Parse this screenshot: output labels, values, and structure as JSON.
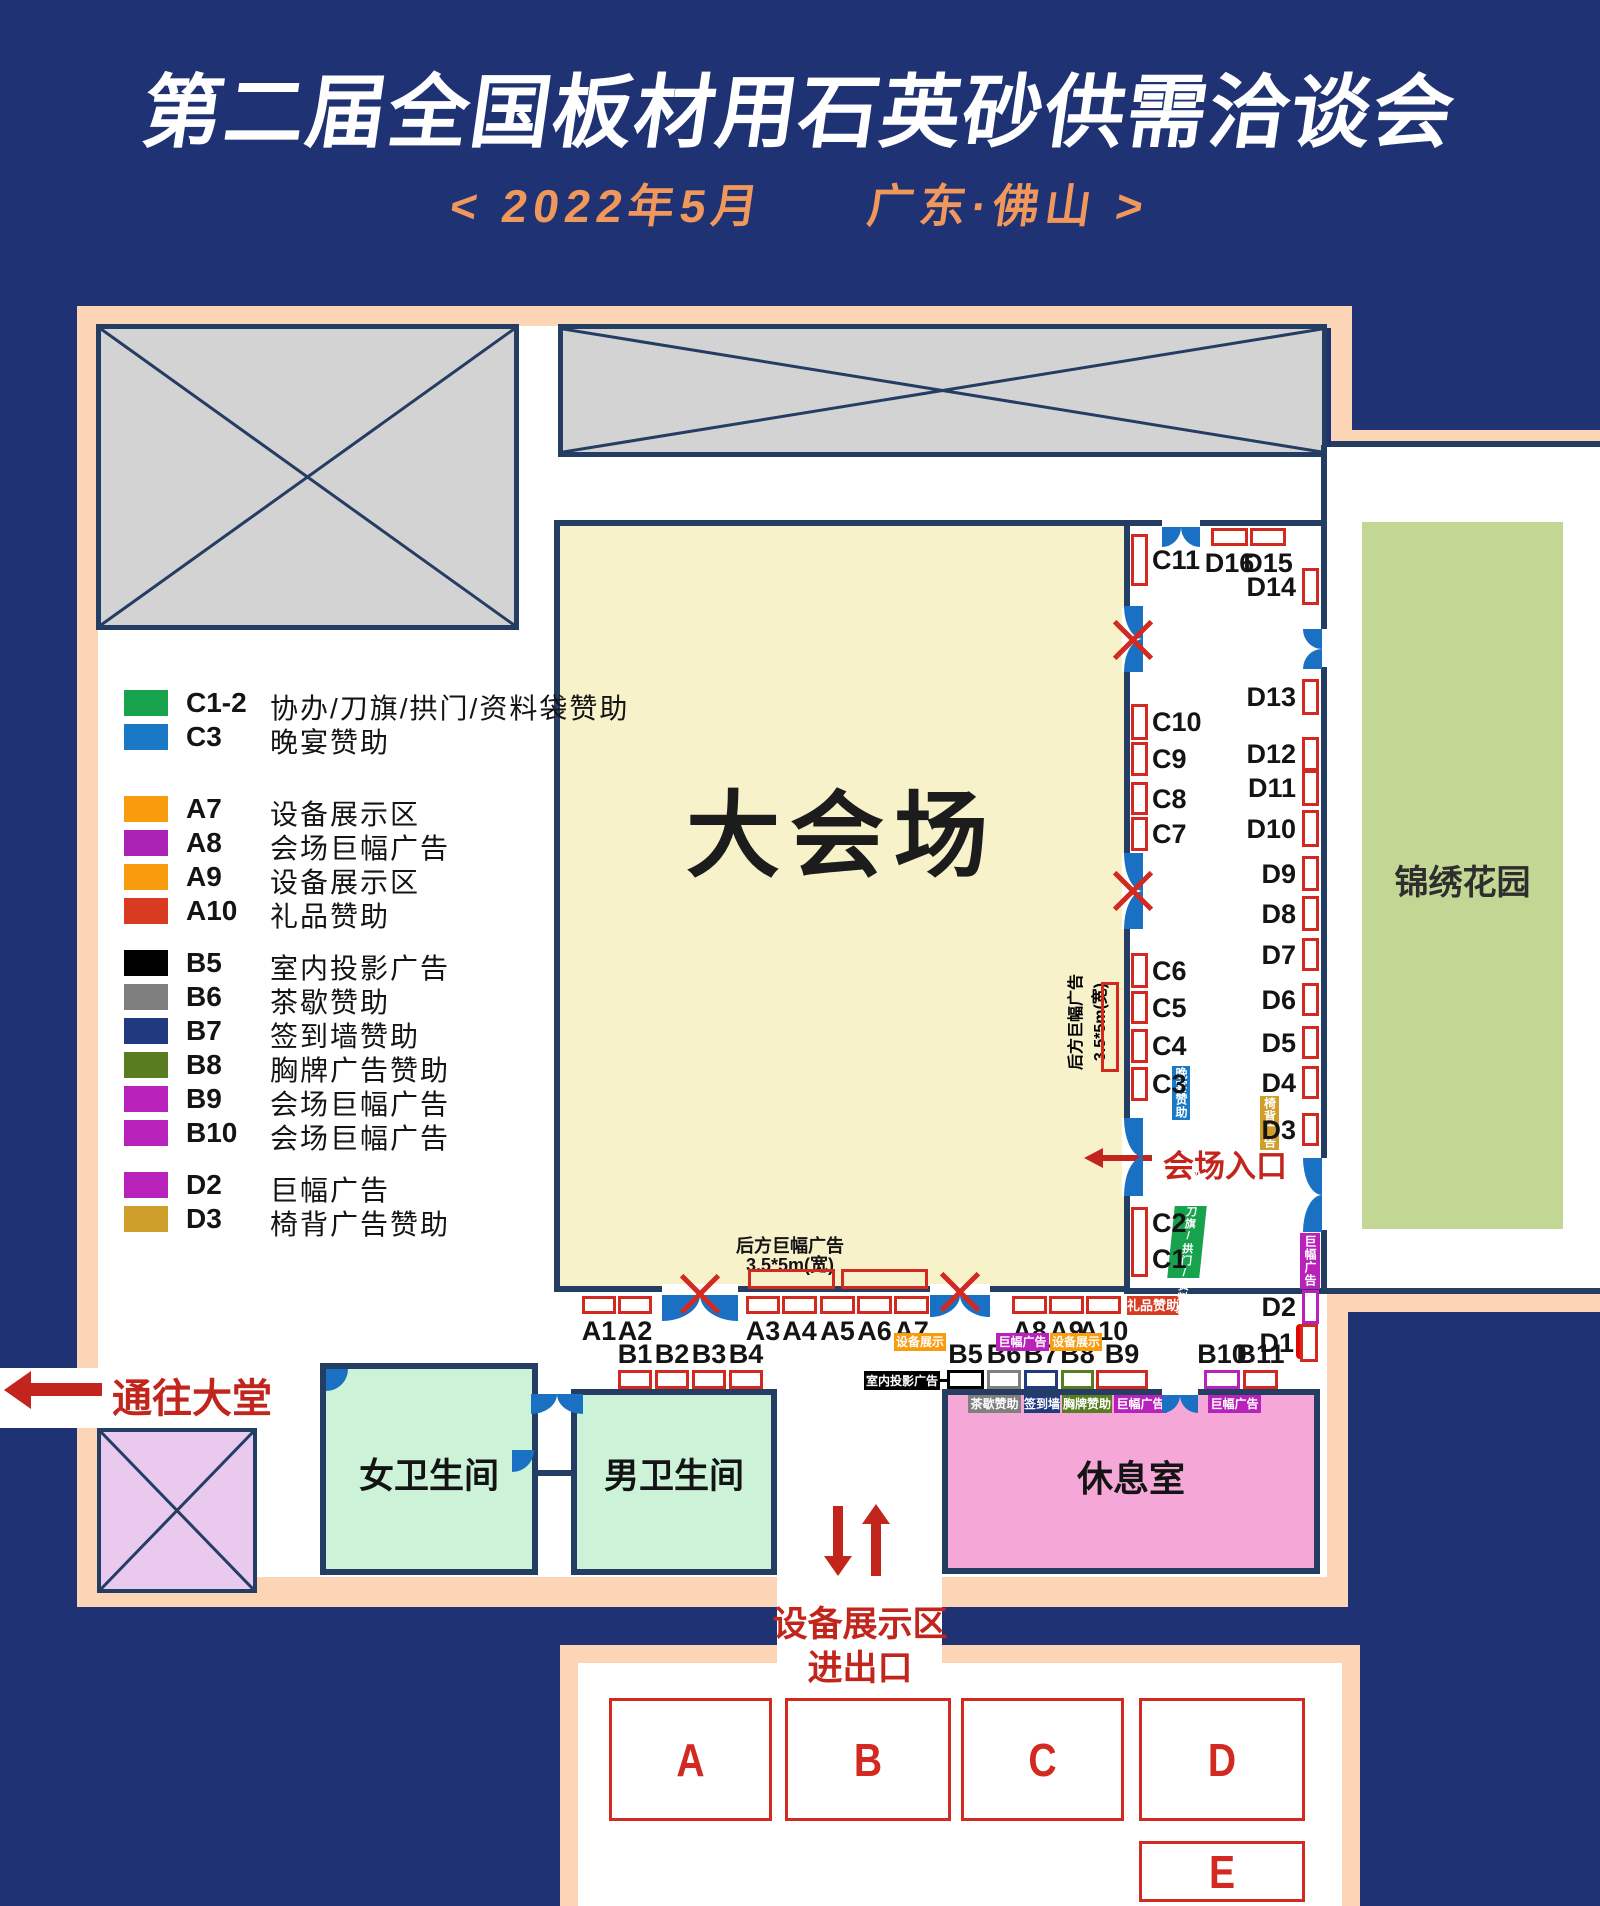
{
  "texts": {
    "title": "第二届全国板材用石英砂供需洽谈会",
    "subtitle": "<  2022年5月　　广东·佛山  >",
    "hall": "大会场",
    "garden": "锦绣花园",
    "lounge": "休息室",
    "women": "女卫生间",
    "men": "男卫生间",
    "lobby": "通往大堂",
    "hall_entrance": "会场入口",
    "equip_line1": "设备展示区",
    "equip_line2": "进出口",
    "rear_banner_line1": "后方巨幅广告",
    "rear_banner_line2": "3.5*5m(宽)"
  },
  "tags": {
    "gift": "礼品赞助",
    "equipment": "设备展示",
    "banner": "巨幅广告",
    "projection": "室内投影广告",
    "tea": "茶歇赞助",
    "signwall": "签到墙",
    "badge": "胸牌赞助",
    "dinner": "晚宴赞助",
    "chair": "椅背广告",
    "coorg": "协办/刀旗/拱门/资料袋"
  },
  "legend": {
    "items": [
      {
        "code": "C1-2",
        "label": "协办/刀旗/拱门/资料袋赞助",
        "color": "#17a24d",
        "group": 0
      },
      {
        "code": "C3",
        "label": "晚宴赞助",
        "color": "#1a79c6",
        "group": 0
      },
      {
        "code": "A7",
        "label": "设备展示区",
        "color": "#f89b0d",
        "group": 1
      },
      {
        "code": "A8",
        "label": "会场巨幅广告",
        "color": "#ab23b5",
        "group": 1
      },
      {
        "code": "A9",
        "label": "设备展示区",
        "color": "#f89b0d",
        "group": 1
      },
      {
        "code": "A10",
        "label": "礼品赞助",
        "color": "#d83b20",
        "group": 1
      },
      {
        "code": "B5",
        "label": "室内投影广告",
        "color": "#000000",
        "group": 2
      },
      {
        "code": "B6",
        "label": "茶歇赞助",
        "color": "#7f7f7f",
        "group": 2
      },
      {
        "code": "B7",
        "label": "签到墙赞助",
        "color": "#20397f",
        "group": 2
      },
      {
        "code": "B8",
        "label": "胸牌广告赞助",
        "color": "#5a7c20",
        "group": 2
      },
      {
        "code": "B9",
        "label": "会场巨幅广告",
        "color": "#b822bb",
        "group": 2
      },
      {
        "code": "B10",
        "label": "会场巨幅广告",
        "color": "#b822bb",
        "group": 2
      },
      {
        "code": "D2",
        "label": "巨幅广告",
        "color": "#b822bb",
        "group": 3
      },
      {
        "code": "D3",
        "label": "椅背广告赞助",
        "color": "#cf9f2b",
        "group": 3
      }
    ]
  },
  "booths": {
    "A1": "A1",
    "A2": "A2",
    "A3": "A3",
    "A4": "A4",
    "A5": "A5",
    "A6": "A6",
    "A7": "A7",
    "A8": "A8",
    "A9": "A9",
    "A10": "A10",
    "B1": "B1",
    "B2": "B2",
    "B3": "B3",
    "B4": "B4",
    "B5": "B5",
    "B6": "B6",
    "B7": "B7",
    "B8": "B8",
    "B9": "B9",
    "B10": "B10",
    "B11": "B11",
    "C1": "C1",
    "C2": "C2",
    "C3": "C3",
    "C4": "C4",
    "C5": "C5",
    "C6": "C6",
    "C7": "C7",
    "C8": "C8",
    "C9": "C9",
    "C10": "C10",
    "C11": "C11",
    "D1": "D1",
    "D2": "D2",
    "D3": "D3",
    "D4": "D4",
    "D5": "D5",
    "D6": "D6",
    "D7": "D7",
    "D8": "D8",
    "D9": "D9",
    "D10": "D10",
    "D11": "D11",
    "D12": "D12",
    "D13": "D13",
    "D14": "D14",
    "D15": "D15",
    "D16": "D16"
  },
  "zones": {
    "A": "A",
    "B": "B",
    "C": "C",
    "D": "D",
    "E": "E"
  },
  "colors": {
    "background_navy": "#1f3374",
    "wall_navy": "#243d63",
    "peach": "#fbd5b5",
    "hall_yellow": "#f8f2cb",
    "gray_block": "#d3d3d3",
    "garden_green": "#c3d795",
    "restroom_mint": "#ccf2d8",
    "lounge_pink": "#f5a8d7",
    "reserved_purple": "#e9c9ee",
    "door_blue": "#1a70c2",
    "booth_red": "#d22920",
    "accent_red_text": "#c2251c",
    "subtitle_orange": "#f0975c"
  }
}
